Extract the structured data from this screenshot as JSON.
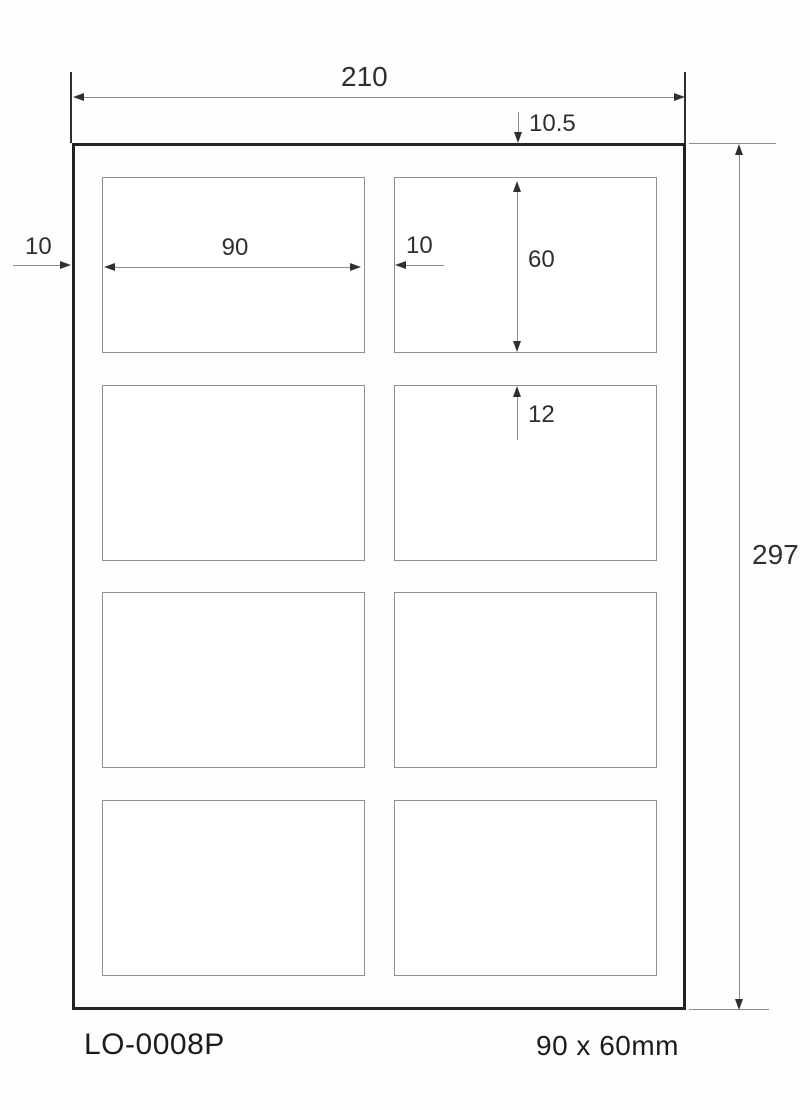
{
  "dims": {
    "sheet_width": "210",
    "sheet_height": "297",
    "top_margin": "10.5",
    "left_margin": "10",
    "label_width": "90",
    "column_gap": "10",
    "label_height": "60",
    "row_gap": "12"
  },
  "footer": {
    "product_code": "LO-0008P",
    "label_format": "90 x 60mm"
  },
  "grid": {
    "rows": 4,
    "columns": 2,
    "label_count": 8
  },
  "colors": {
    "sheet_border": "#222222",
    "label_border": "#8f8f8f",
    "dimension_line": "#8c8c8c",
    "arrowhead": "#2f2f2f",
    "text": "#2f2f2f",
    "background": "#fefefe"
  }
}
